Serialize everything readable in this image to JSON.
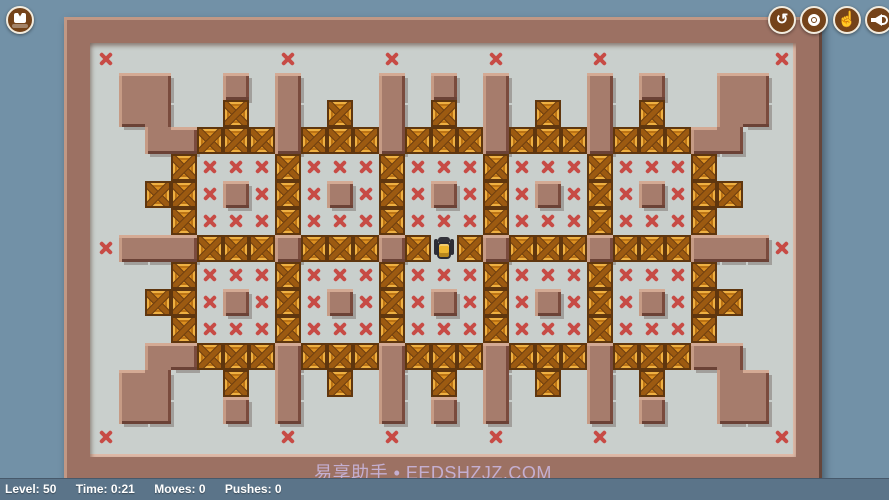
{
  "toolbar": {
    "levels_button": {
      "icon": "levels-icon"
    },
    "undo_button": {
      "icon": "undo-icon",
      "glyph": "↺"
    },
    "restart_button": {
      "icon": "restart-icon"
    },
    "hint_button": {
      "icon": "hand-pointer-icon",
      "glyph": "☝"
    },
    "sound_button": {
      "icon": "speaker-icon"
    }
  },
  "status_bar": {
    "level_label": "Level: 50",
    "time_label": "Time: 0:21",
    "moves_label": "Moves: 0",
    "pushes_label": "Pushes: 0"
  },
  "watermark": "易享助手 • EEDSHZJZ.COM",
  "board": {
    "columns": 27,
    "rows": 15,
    "tile_width": 26,
    "tile_height": 27,
    "legend": {
      "#": "wall",
      ".": "floor",
      "x": "goal",
      "c": "crate",
      "p": "player"
    },
    "map": [
      "x......x...x...x...x......x",
      ".##..#.#...#.#.#...#.#..##.",
      ".##..c.#.c.#.c.#.c.#.c..##.",
      "..##ccc#ccc#ccc#ccc#ccc##..",
      "...cxxxcxxxcxxxcxxxcxxxc...",
      "..ccx#xcx#xcx#xcx#xcx#xcc..",
      "...cxxxcxxxcxxxcxxxcxxxc...",
      "x###ccc#ccc#cpc#ccc#ccc###x",
      "...cxxxcxxxcxxxcxxxcxxxc...",
      "..ccx#xcx#xcx#xcx#xcx#xcc..",
      "...cxxxcxxxcxxxcxxxcxxxc...",
      "..##ccc#ccc#ccc#ccc#ccc##..",
      ".##..c.#.c.#.c.#.c.#.c..##.",
      ".##..#.#...#.#.#...#.#..##.",
      "x......x...x...x...x......x"
    ]
  },
  "colors": {
    "background": "#7291a7",
    "frame": "#9c7163",
    "wall": "#a67c6c",
    "floor": "#c9cfcc",
    "goal_x": "#c74b45",
    "crate": "#dc9020",
    "player_body": "#ecb52e",
    "status_bar_bg": "#5b7489",
    "button_bg": "#74431a",
    "watermark_text": "#c9b6de"
  }
}
